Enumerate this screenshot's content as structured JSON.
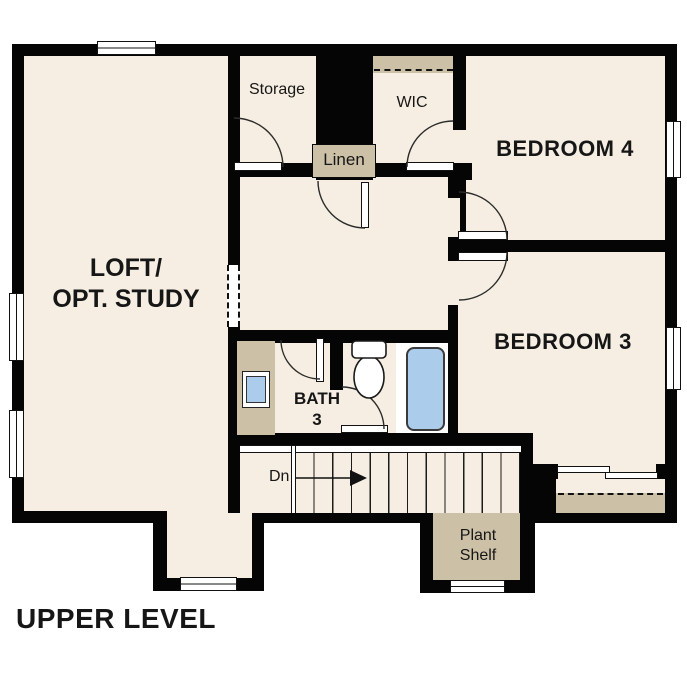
{
  "title": "UPPER LEVEL",
  "colors": {
    "wall": "#050505",
    "floor": "#f6eee2",
    "shelf": "#ccc1a7",
    "fixture": "#acccec",
    "line": "#2b2b2b"
  },
  "rooms": {
    "loft": {
      "line1": "LOFT/",
      "line2": "OPT. STUDY"
    },
    "storage": {
      "label": "Storage"
    },
    "wic": {
      "label": "WIC"
    },
    "linen": {
      "label": "Linen"
    },
    "bedroom4": {
      "label": "BEDROOM 4"
    },
    "bedroom3": {
      "label": "BEDROOM 3"
    },
    "bath3": {
      "line1": "BATH",
      "line2": "3"
    },
    "plant_shelf": {
      "line1": "Plant",
      "line2": "Shelf"
    }
  },
  "stairs": {
    "down_label": "Dn"
  }
}
